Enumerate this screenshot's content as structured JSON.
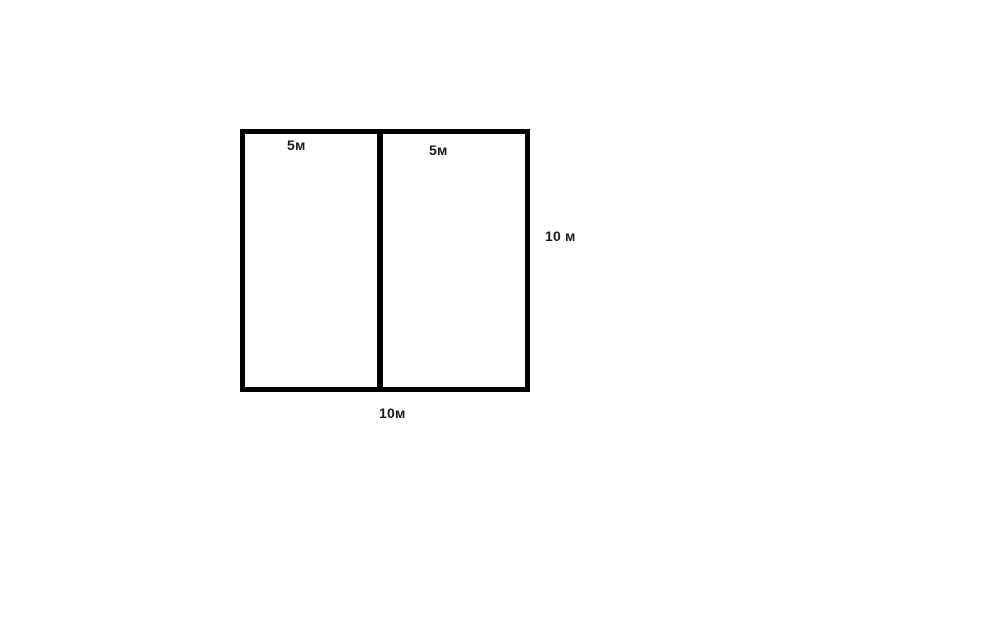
{
  "diagram": {
    "description": "Square divided into two equal vertical halves",
    "background_color": "#ffffff",
    "line_color": "#000000",
    "text_color": "#1c1c1c",
    "labels": {
      "left_half_width": "5м",
      "right_half_width": "5м",
      "side_height": "10 м",
      "bottom_total_width": "10м"
    }
  }
}
